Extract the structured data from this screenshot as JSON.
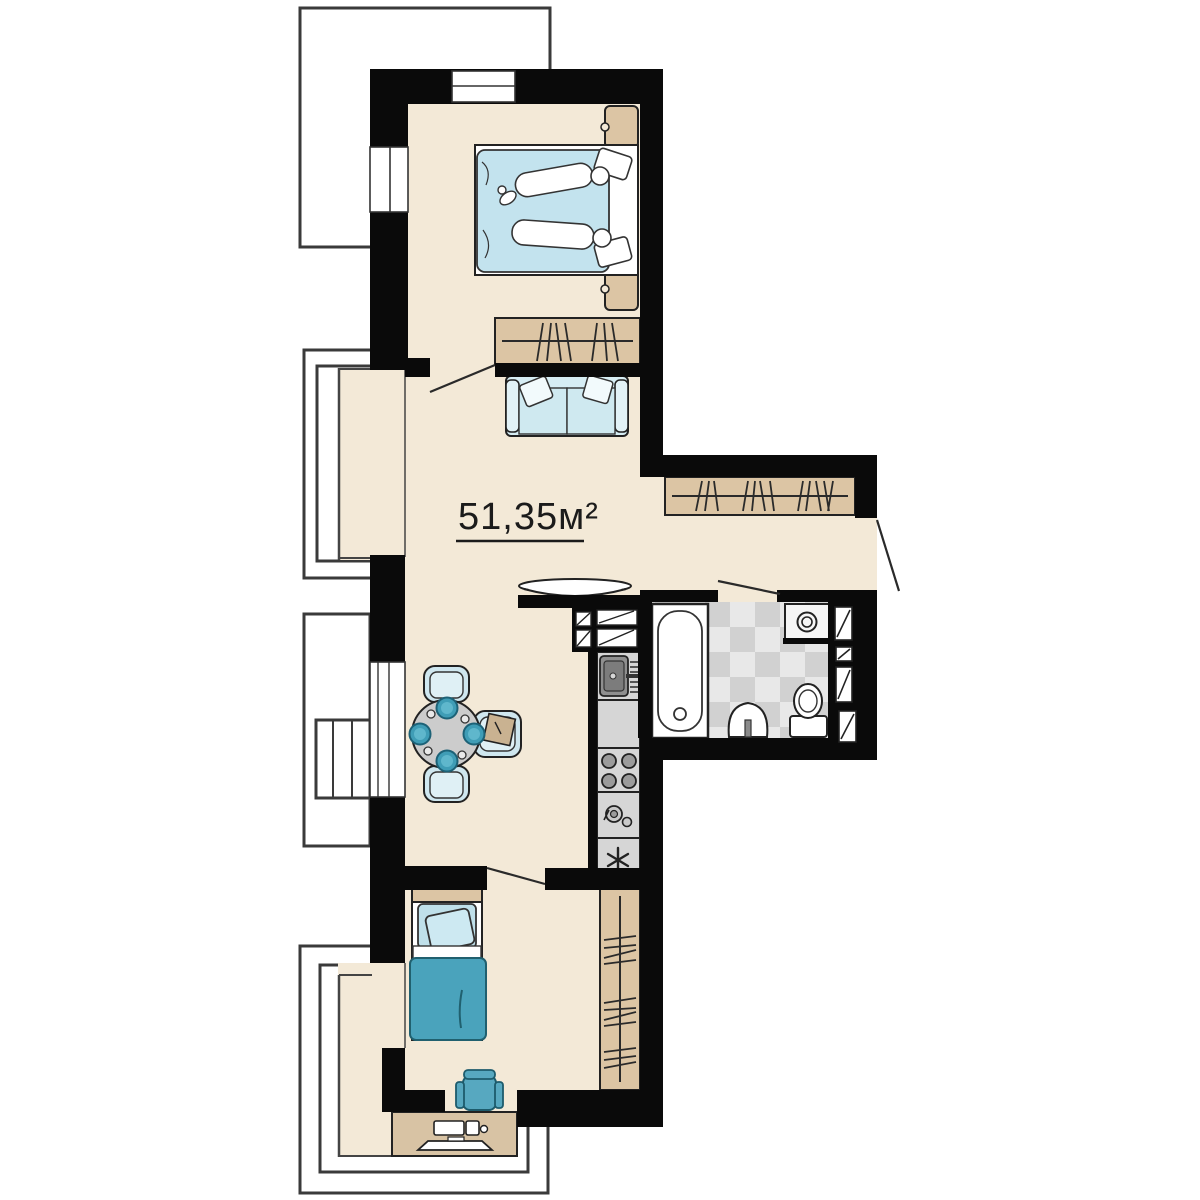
{
  "plan": {
    "area_label": "51,35м²",
    "area_value": "51,35",
    "area_unit": "м²",
    "fridge_symbol": "✳"
  },
  "colors": {
    "background": "#ffffff",
    "wall": "#0a0a0a",
    "floor": "#f3e9d7",
    "wood": "#dcc5a4",
    "desk_wood": "#d8c3a4",
    "teal": "#4aa3bc",
    "teal_dark": "#20606f",
    "plate_teal": "#3f9db6",
    "light_blue": "#c3e3ee",
    "sofa_blue": "#d6edf4",
    "counter_gray": "#d6d6d6",
    "sink_gray": "#8f8f8f",
    "table_gray": "#cccccc",
    "tile_light": "#e8e8e8",
    "tile_dark": "#d1d1d1",
    "outline": "#222222",
    "balcony_line": "#3a3a3a"
  },
  "rooms": [
    {
      "name": "bedroom-1"
    },
    {
      "name": "living-dining"
    },
    {
      "name": "kitchen"
    },
    {
      "name": "hallway"
    },
    {
      "name": "bathroom"
    },
    {
      "name": "bedroom-2"
    },
    {
      "name": "balconies"
    }
  ],
  "icons": [
    {
      "name": "double-bed-icon",
      "shape": "rect+duvet+pillows+figures"
    },
    {
      "name": "single-bed-icon",
      "shape": "rect+duvet+pillow"
    },
    {
      "name": "nightstand-icon",
      "shape": "rounded-rect+knob"
    },
    {
      "name": "wardrobe-icon",
      "shape": "rect+rail+hanger-hatches"
    },
    {
      "name": "sofa-icon",
      "shape": "rect+cushions+pillows"
    },
    {
      "name": "tv-icon",
      "shape": "flat-ellipse-on-wall"
    },
    {
      "name": "dining-table-icon",
      "shape": "circle+plates"
    },
    {
      "name": "chair-icon",
      "shape": "rounded-rect"
    },
    {
      "name": "kitchen-sink-icon",
      "shape": "dark-rect+drainboard+faucet"
    },
    {
      "name": "stove-icon",
      "shape": "four-burner-circles"
    },
    {
      "name": "small-appliance-icon",
      "shape": "two-circles"
    },
    {
      "name": "fridge-icon",
      "shape": "six-spoke-asterisk"
    },
    {
      "name": "bathtub-icon",
      "shape": "rect+inner-oval+drain"
    },
    {
      "name": "washing-machine-icon",
      "shape": "square+porthole"
    },
    {
      "name": "wash-basin-icon",
      "shape": "half-oval+pedestal"
    },
    {
      "name": "toilet-icon",
      "shape": "tank+bowl"
    },
    {
      "name": "door-swing-icon",
      "shape": "diagonal-leaf-line"
    },
    {
      "name": "window-icon",
      "shape": "white-gap+mullion"
    },
    {
      "name": "desk-icon",
      "shape": "rect+keyboard+monitor+mouse"
    }
  ]
}
